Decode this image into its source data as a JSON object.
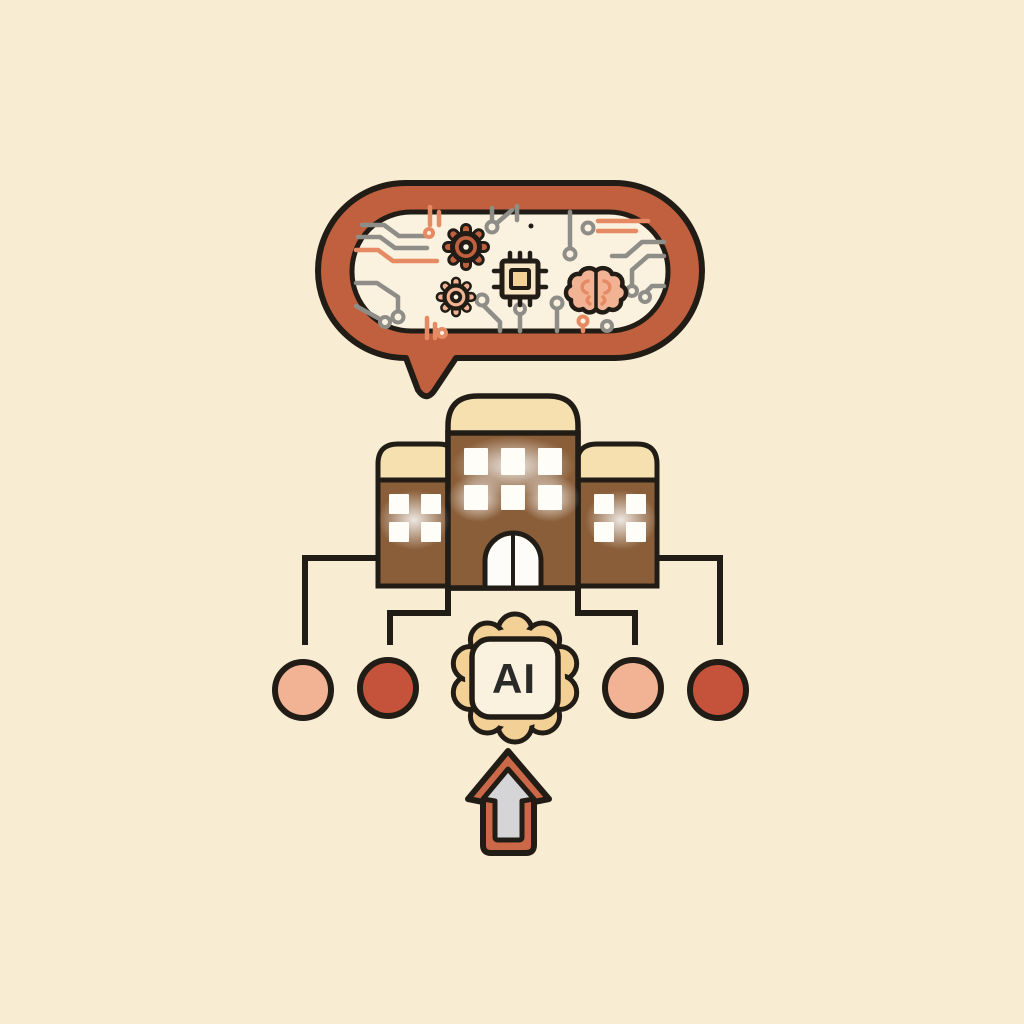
{
  "palette": {
    "background": "#f8ecd2",
    "outline": "#211d16",
    "terracotta": "#c0603e",
    "salmon": "#e58a63",
    "peach": "#f2b394",
    "red": "#c5523a",
    "brown": "#8a5e38",
    "cream": "#f6e0b0",
    "cream_light": "#faf1de",
    "chip_body": "#f6e6c4",
    "tan": "#f2d096",
    "gray_line": "#8f8d88",
    "arrow_band": "#ca6848",
    "arrow_fill": "#d5d5d7",
    "window_white": "#fffdf7",
    "text": "#2a2a28"
  },
  "speech_bubble": {
    "shape": "rounded-pill-with-tail",
    "pattern": "circuit-traces",
    "icons": [
      {
        "name": "gear-icon",
        "color": "terracotta"
      },
      {
        "name": "gear-icon",
        "color": "peach"
      },
      {
        "name": "chip-icon",
        "color": "cream"
      },
      {
        "name": "brain-icon",
        "color": "peach"
      }
    ]
  },
  "building": {
    "name": "school-building-icon",
    "center_windows": 6,
    "wing_windows": 4,
    "door": "arched-double"
  },
  "nodes": [
    {
      "name": "circle-node",
      "color": "peach"
    },
    {
      "name": "circle-node",
      "color": "red"
    },
    {
      "name": "circle-node",
      "color": "peach"
    },
    {
      "name": "circle-node",
      "color": "red"
    }
  ],
  "ai_badge": {
    "label": "AI",
    "shape": "flower-badge",
    "petals": 10
  },
  "arrow": {
    "name": "arrow-up-icon",
    "direction": "up"
  }
}
